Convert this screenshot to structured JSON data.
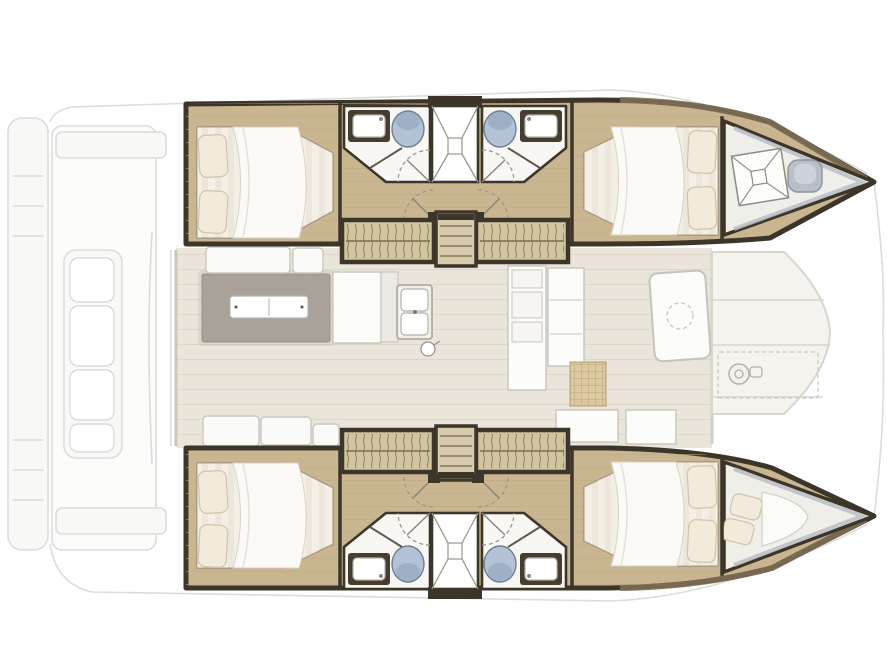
{
  "meta": {
    "label": "Catamaran interior floor plan, bow to the right",
    "visible_text": []
  },
  "colors": {
    "bg": "#ffffff",
    "ghost_line": "#dcdcda",
    "ghost_fill": "#f8f8f7",
    "hull_floor": "#c9b690",
    "corridor_floor": "#d7cbae",
    "wall_dark": "#3c352a",
    "wood_trim": "#7d6e55",
    "bow_floor": "#efeee8",
    "bath_floor": "#f8f7f4",
    "shower_line": "#9b978c",
    "sink_frame": "#453d2f",
    "sink_basin": "#ffffff",
    "toilet_fill": "#b3c2d4",
    "toilet_dark": "#9db0c6",
    "toilet_line": "#6e7f95",
    "stairs_fill": "#d1c4a1",
    "stairs_line": "#97875f",
    "salon_floor": "#eae5da",
    "plank_line": "#ded7c8",
    "hull_plank_line": "#bcab86",
    "table_fill": "#a8a29a",
    "bench_fill": "#fafaf8",
    "bench_line": "#cbc8c1",
    "bed_sheet": "#fbfaf6",
    "mattress_a": "#ece3d3",
    "mattress_b": "#dfd4bf",
    "pillow_fill": "#f2ebdc",
    "pillow_line": "#d2c5ac",
    "counter_fill": "#fcfcfa",
    "counter_line": "#c8c5bd",
    "hatch_fill": "#dcc9a2",
    "hatch_line": "#b49b6d",
    "foredeck_fill": "#f4f3ee",
    "foredeck_line": "#d9d6cb",
    "gray_fitting": "#b9bfc7",
    "gray_fitting_line": "#8d949d"
  },
  "floorplan": {
    "vessel_type": "catamaran",
    "orientation": "bow-right",
    "salon": [
      "dining-table",
      "settee-cushions",
      "galley-counter",
      "double-sink",
      "kettle",
      "appliance-cabinets",
      "storage-cabinets",
      "rattan-hatch",
      "forward-door"
    ],
    "port_hull": [
      "aft-double-bed",
      "aft-head-sink",
      "aft-toilet",
      "central-shower",
      "forward-toilet",
      "forward-head-sink",
      "double-door-lobby",
      "stair-flights",
      "companionway-ladder",
      "forward-double-bed",
      "bow-deck-hatch",
      "bow-fitting"
    ],
    "starboard_hull": [
      "aft-double-bed",
      "aft-head-sink",
      "aft-toilet",
      "central-shower",
      "forward-toilet",
      "forward-head-sink",
      "double-door-lobby",
      "stair-flights",
      "companionway-ladder",
      "forward-double-bed",
      "forepeak-berth"
    ],
    "foredeck": [
      "deck-lockers",
      "anchor-windlass"
    ],
    "aft_deck": [
      "transom-platform",
      "aft-structure",
      "cockpit-bench"
    ],
    "counts": {
      "double_beds": 4,
      "toilets": 4,
      "bathroom_sinks": 4,
      "showers": 2,
      "stair_flights": 4,
      "forepeak_berths": 1
    }
  }
}
